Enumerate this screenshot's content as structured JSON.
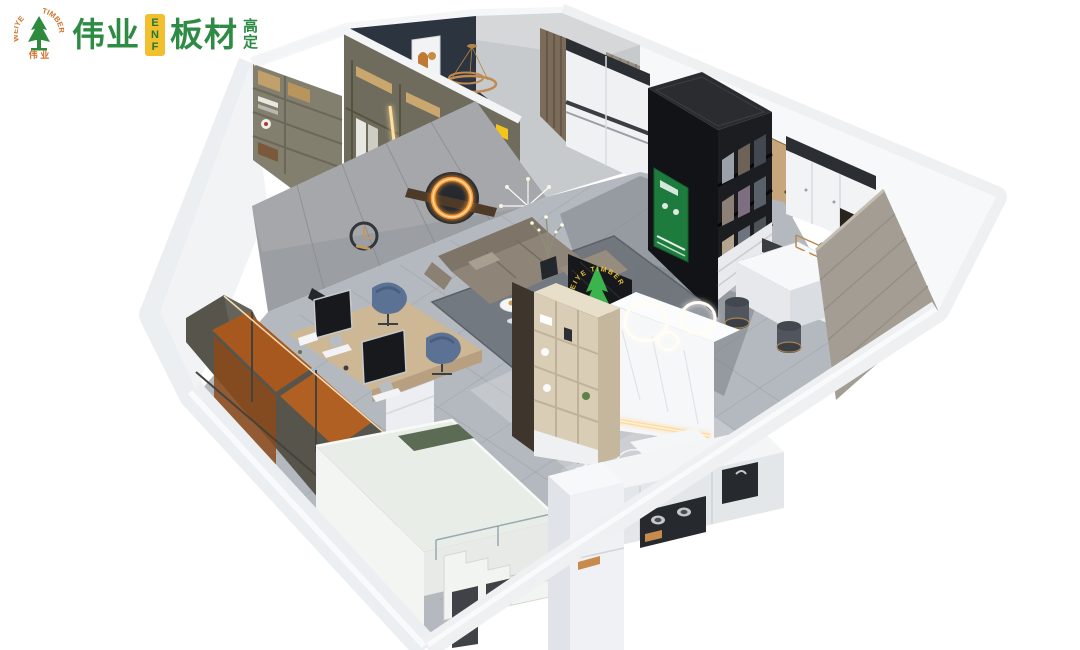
{
  "logo": {
    "emblem": {
      "arc_left": "WEIYE",
      "arc_right": "TIMBER",
      "bottom": "伟 业"
    },
    "wordmark_1": "伟业",
    "badge": "ENF",
    "badge_letters": [
      "E",
      "N",
      "F"
    ],
    "wordmark_2": "板材",
    "tagline_chars": [
      "高",
      "定"
    ]
  },
  "reception_sign": {
    "arc_text": "WEIYE TIMBER"
  },
  "palette": {
    "brand_green": "#2e8b44",
    "brand_orange": "#d2722a",
    "badge_yellow": "#f2bf2e",
    "poster_green": "#1e7b3e",
    "navy_wall": "#2c3440",
    "gray_wall": "#9b9ea2",
    "floor_tile": "#b4b9bf",
    "wood_door": "#c7a67c",
    "wardrobe_orange": "#a6581f",
    "led_warm": "#ffc87a",
    "sofa_gray": "#8e8578",
    "chair_blue": "#5b7294"
  },
  "scene": {
    "kind": "3d-isometric-cutaway-showroom-render",
    "areas": [
      "walk-in-closet",
      "bedroom",
      "office-living-area",
      "material-display-cabinet",
      "reception-counter",
      "tea-bar",
      "kitchen-run",
      "loft-stairs"
    ]
  }
}
